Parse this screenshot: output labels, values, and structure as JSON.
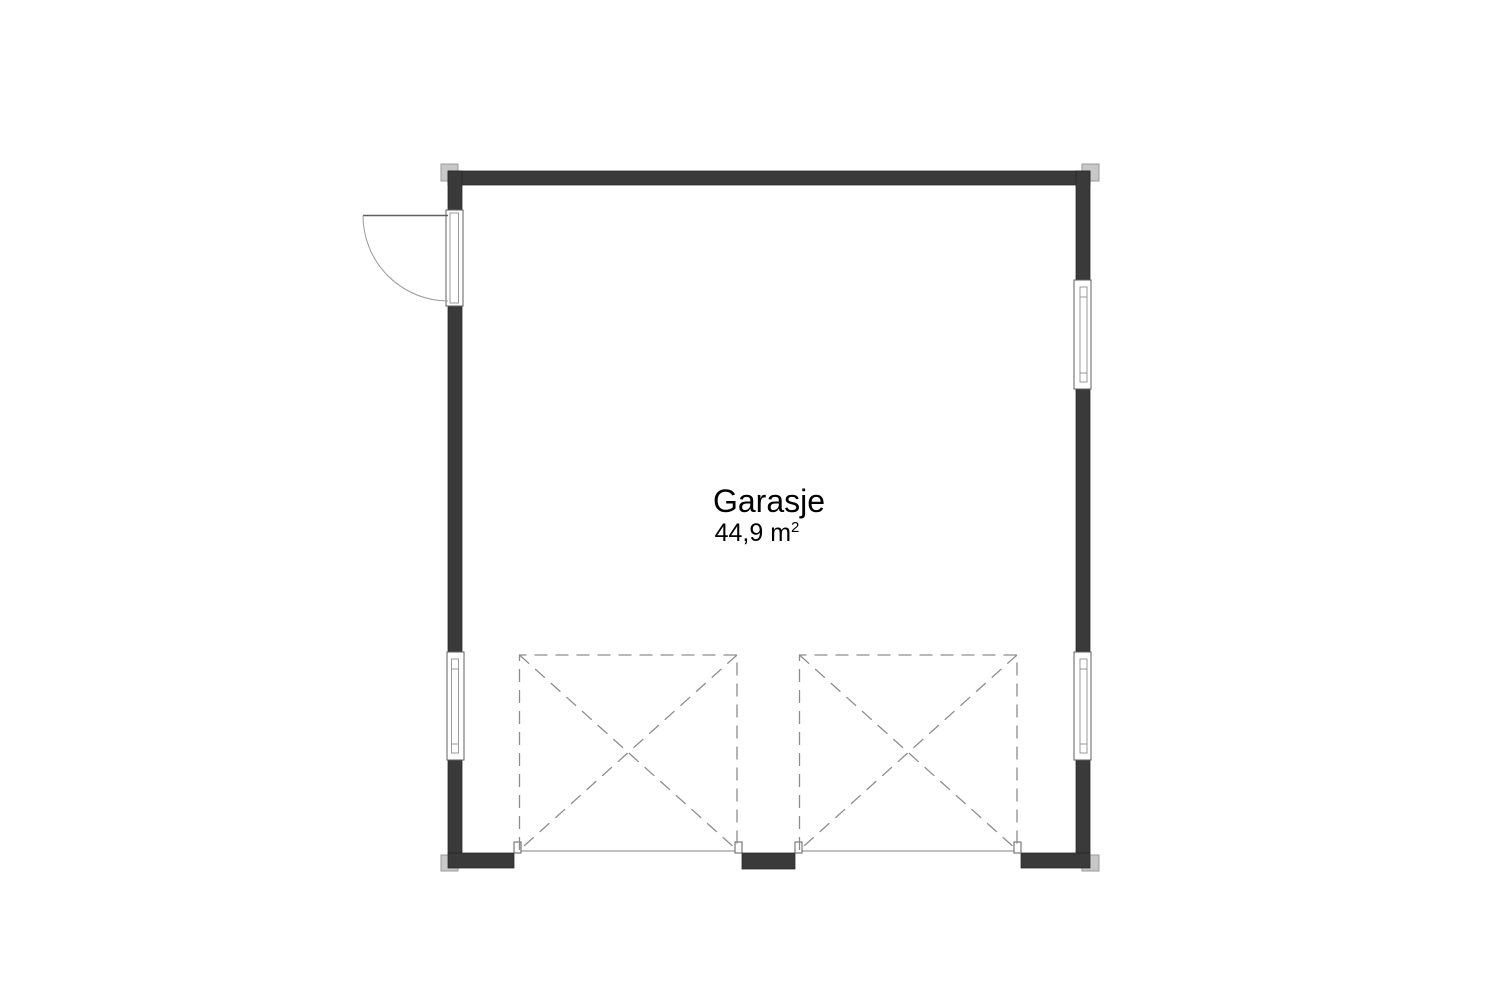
{
  "room": {
    "name": "Garasje",
    "area": "44,9 m",
    "area_exponent": "2"
  },
  "colors": {
    "background": "#ffffff",
    "wall": "#3a3a3a",
    "wall-edge": "#262626",
    "line": "#5f5f5f",
    "thin-line": "#9a9a9a",
    "dashed": "#8d8d8d",
    "cap": "#c8c8c8",
    "cap-edge": "#9a9a9a",
    "text": "#000000"
  }
}
